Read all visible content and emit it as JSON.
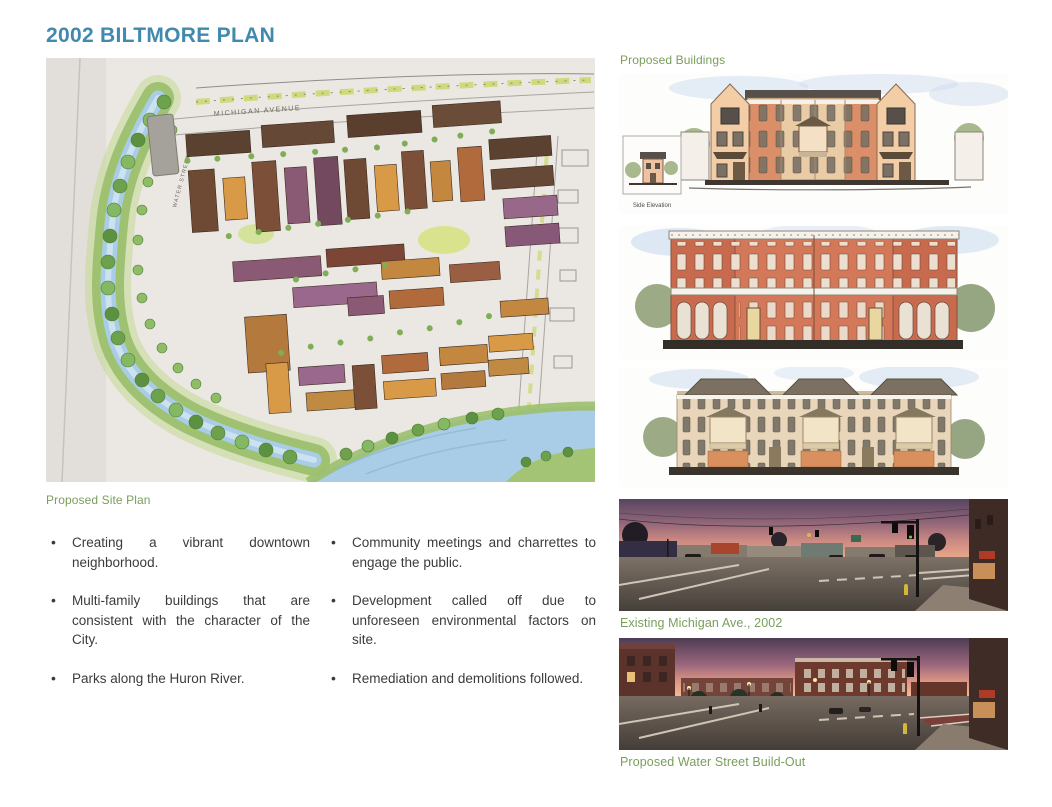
{
  "page": {
    "title": "2002 BILTMORE PLAN"
  },
  "colors": {
    "title_accent": "#4189ae",
    "caption_green": "#7a9e5c",
    "body_text": "#3b3b3b"
  },
  "site_plan": {
    "caption": "Proposed Site Plan",
    "labels": {
      "michigan_avenue": "MICHIGAN AVENUE",
      "water_street": "WATER STREET"
    }
  },
  "bullets": {
    "left": [
      "Creating a vibrant downtown neighborhood.",
      "Multi-family buildings that are consistent with the character of the City.",
      "Parks along the Huron River."
    ],
    "right": [
      "Community meetings and charrettes to engage the public.",
      "Development called off due to unforeseen environmental factors on site.",
      "Remediation and demolitions followed."
    ]
  },
  "proposed_buildings": {
    "label": "Proposed Buildings",
    "side_elevation_caption": "Side Elevation"
  },
  "photos": {
    "existing_caption": "Existing Michigan Ave., 2002",
    "build_out_caption": "Proposed Water Street Build-Out"
  }
}
